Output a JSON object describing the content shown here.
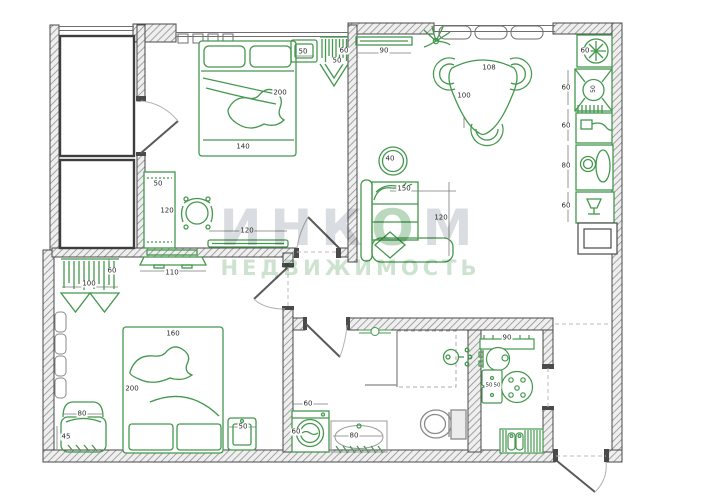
{
  "watermark": {
    "brand_part1": "ИНК",
    "brand_accent": "О",
    "brand_part2": "М",
    "subtitle": "НЕДВИЖИМОСТЬ"
  },
  "colors": {
    "furniture_green": "#44984e",
    "wall_gray": "#4a4a4a",
    "dimension_text": "#2b2b2b",
    "watermark_gray": "#d9dce0",
    "watermark_green": "#cde3d0"
  },
  "dimension_labels": [
    {
      "text": "140",
      "x": 243,
      "y": 147
    },
    {
      "text": "200",
      "x": 280,
      "y": 93
    },
    {
      "text": "50",
      "x": 303,
      "y": 52
    },
    {
      "text": "60",
      "x": 344,
      "y": 51
    },
    {
      "text": "50",
      "x": 337,
      "y": 61
    },
    {
      "text": "90",
      "x": 384,
      "y": 51
    },
    {
      "text": "108",
      "x": 489,
      "y": 68
    },
    {
      "text": "100",
      "x": 464,
      "y": 96
    },
    {
      "text": "60",
      "x": 585,
      "y": 51
    },
    {
      "text": "50",
      "x": 594,
      "y": 89,
      "vertical": true,
      "size": 6
    },
    {
      "text": "60",
      "x": 566,
      "y": 88
    },
    {
      "text": "60",
      "x": 566,
      "y": 126
    },
    {
      "text": "80",
      "x": 566,
      "y": 166
    },
    {
      "text": "60",
      "x": 566,
      "y": 206
    },
    {
      "text": "40",
      "x": 390,
      "y": 159
    },
    {
      "text": "150",
      "x": 404,
      "y": 189
    },
    {
      "text": "120",
      "x": 441,
      "y": 218
    },
    {
      "text": "50",
      "x": 158,
      "y": 184
    },
    {
      "text": "120",
      "x": 167,
      "y": 211
    },
    {
      "text": "120",
      "x": 247,
      "y": 231
    },
    {
      "text": "110",
      "x": 172,
      "y": 273
    },
    {
      "text": "100",
      "x": 89,
      "y": 284
    },
    {
      "text": "60",
      "x": 112,
      "y": 271
    },
    {
      "text": "160",
      "x": 173,
      "y": 334
    },
    {
      "text": "200",
      "x": 132,
      "y": 389
    },
    {
      "text": "80",
      "x": 82,
      "y": 414
    },
    {
      "text": "45",
      "x": 66,
      "y": 437
    },
    {
      "text": "50",
      "x": 243,
      "y": 427
    },
    {
      "text": "60",
      "x": 308,
      "y": 404
    },
    {
      "text": "60",
      "x": 296,
      "y": 432
    },
    {
      "text": "80",
      "x": 354,
      "y": 436
    },
    {
      "text": "90",
      "x": 507,
      "y": 338
    },
    {
      "text": "50",
      "x": 489,
      "y": 386,
      "size": 5.5
    },
    {
      "text": "50",
      "x": 497,
      "y": 386,
      "size": 5.5
    }
  ]
}
